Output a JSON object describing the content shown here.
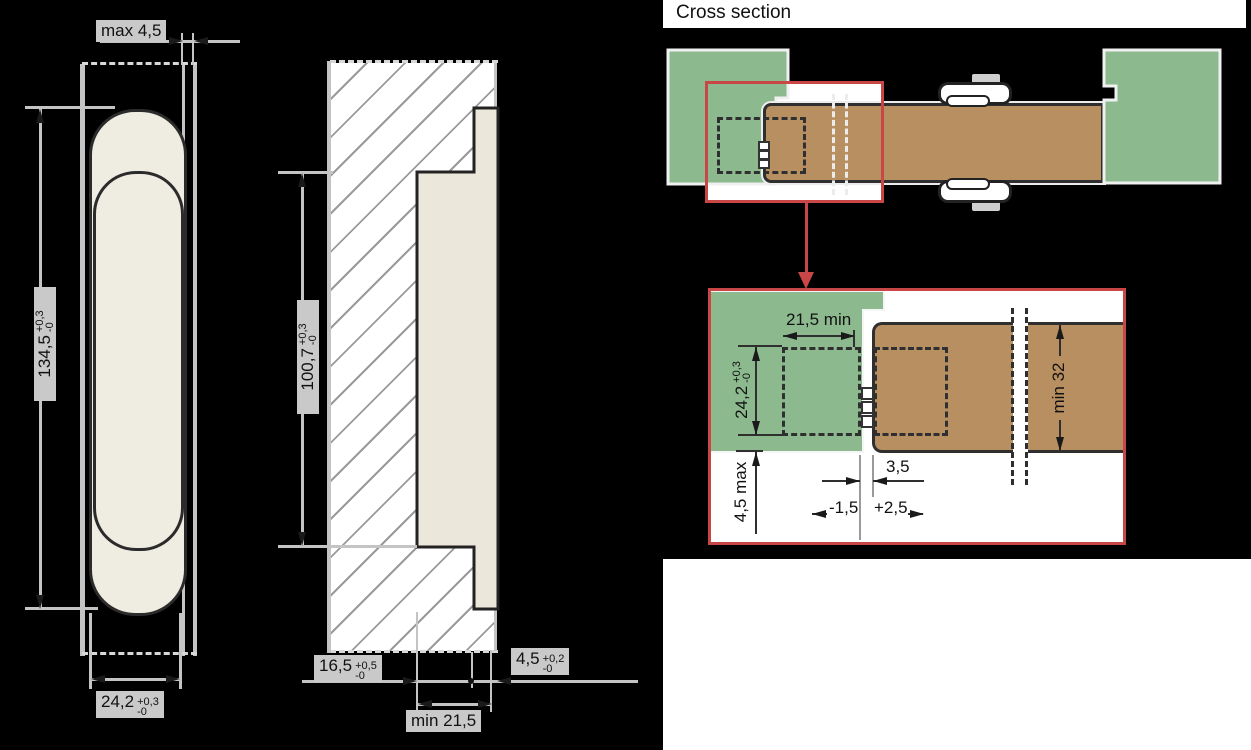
{
  "cross_section": {
    "title": "Cross section"
  },
  "front_view": {
    "dim_top": "max 4,5",
    "dim_height": {
      "value": "134,5",
      "tol_plus": "+0,3",
      "tol_minus": "-0"
    },
    "dim_width": {
      "value": "24,2",
      "tol_plus": "+0,3",
      "tol_minus": "-0"
    }
  },
  "side_view": {
    "dim_height": {
      "value": "100,7",
      "tol_plus": "+0,3",
      "tol_minus": "-0"
    },
    "dim_depth": {
      "value": "16,5",
      "tol_plus": "+0,5",
      "tol_minus": "-0"
    },
    "dim_face": {
      "value": "4,5",
      "tol_plus": "+0,2",
      "tol_minus": "-0"
    },
    "dim_min_width": "min 21,5"
  },
  "detail": {
    "dim_overlay": "21,5 min",
    "dim_cup": {
      "value": "24,2",
      "tol_plus": "+0,3",
      "tol_minus": "-0"
    },
    "dim_door_thickness": "min 32",
    "dim_gap_max": "4,5 max",
    "dim_gap": "3,5",
    "adjust_minus": "-1,5",
    "adjust_plus": "+2,5"
  },
  "colors": {
    "frame_green": "#8cba8e",
    "door_brown": "#b88f60",
    "accent_red": "#c94646",
    "faceplate_cream": "#efece1"
  }
}
